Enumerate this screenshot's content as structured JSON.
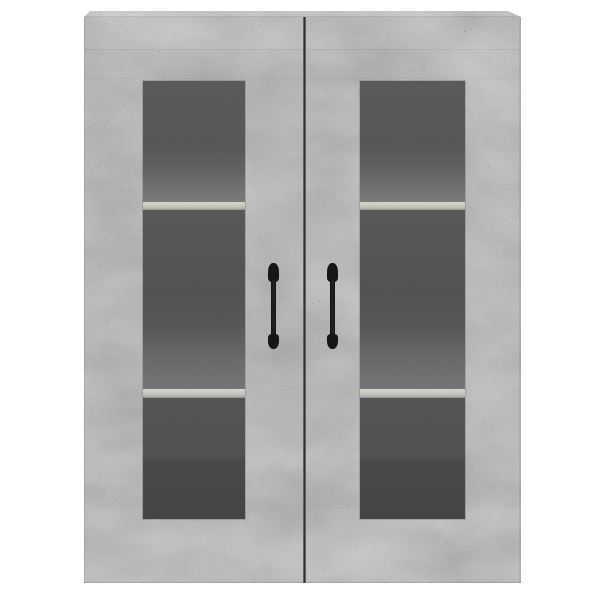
{
  "meta": {
    "image_type": "product photo",
    "background_color": "#ffffff"
  },
  "scene": {
    "label": "Product photo of a concrete grey wall-mounted cabinet",
    "description": "Rectangular wall cabinet in concrete grey finish, viewed frontally on a plain white background. Two glass-panel doors with black vertical handles reveal three interior compartments per side separated by two shelves."
  },
  "cabinet": {
    "label": "Concrete grey wall cabinet with glass doors",
    "finish": "concrete grey",
    "door_count": 2,
    "handle_style": "black vertical bar pull",
    "colors": {
      "body": "#bdbdbd",
      "top_edge": "#cbcbcb",
      "interior_back": "#565656",
      "interior_floor": "#757575",
      "shelf_front": "#c7c6bf",
      "handle": "#161616",
      "door_gap": "#303030"
    },
    "doors": [
      {
        "label": "Left glass door",
        "window_label": "Left door glass panel",
        "handle_label": "Left door handle",
        "compartments": 3,
        "shelves": 2
      },
      {
        "label": "Right glass door",
        "window_label": "Right door glass panel",
        "handle_label": "Right door handle",
        "compartments": 3,
        "shelves": 2
      }
    ]
  }
}
